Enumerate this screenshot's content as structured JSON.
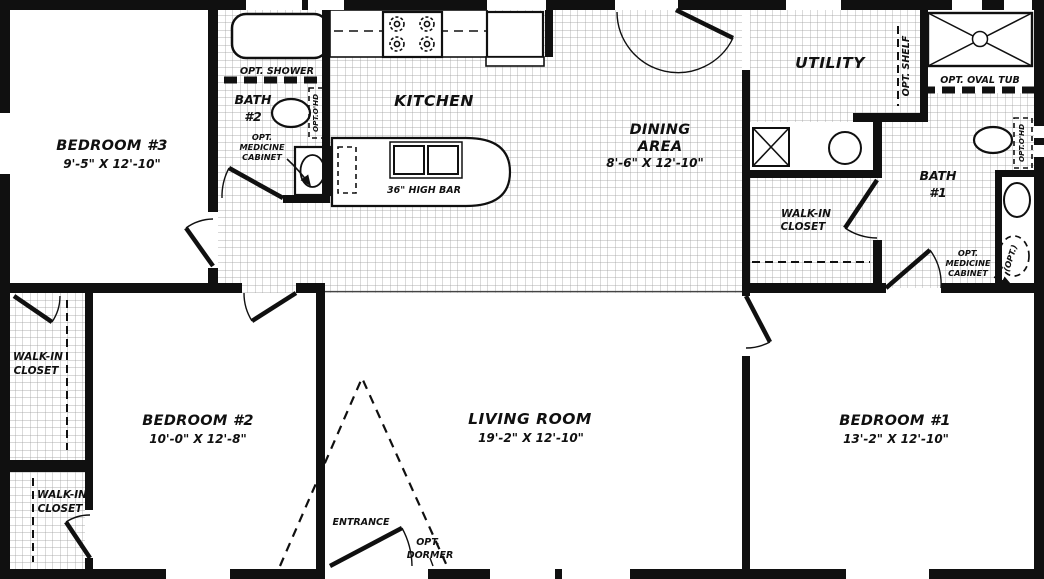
{
  "rooms": {
    "bedroom3": {
      "name": "BEDROOM #3",
      "dims": "9'-5\" X 12'-10\""
    },
    "bath2": {
      "line1": "BATH",
      "line2": "#2"
    },
    "kitchen": {
      "name": "KITCHEN"
    },
    "dining": {
      "line1": "DINING",
      "line2": "AREA",
      "dims": "8'-6\" X 12'-10\""
    },
    "utility": {
      "name": "UTILITY"
    },
    "bath1": {
      "line1": "BATH",
      "line2": "#1"
    },
    "bedroom2": {
      "name": "BEDROOM #2",
      "dims": "10'-0\" X 12'-8\""
    },
    "living": {
      "name": "LIVING ROOM",
      "dims": "19'-2\" X 12'-10\""
    },
    "bedroom1": {
      "name": "BEDROOM #1",
      "dims": "13'-2\" X 12'-10\""
    },
    "walkin": {
      "line1": "WALK-IN",
      "line2": "CLOSET"
    }
  },
  "labels": {
    "opt_shower": "OPT. SHOWER",
    "opt_oval_tub": "OPT. OVAL TUB",
    "opt_shelf": "OPT. SHELF",
    "opt_ohd": "OPT.O'HD",
    "opt_med1": "OPT.",
    "opt_med2": "MEDICINE",
    "opt_med3": "CABINET",
    "high_bar": "36\" HIGH BAR",
    "entrance": "ENTRANCE",
    "opt_dormer1": "OPT.",
    "opt_dormer2": "DORMER",
    "opt_toilet": "(OPT.)"
  },
  "colors": {
    "wall": "#101010",
    "tile_line": "#989898",
    "background": "#ffffff"
  }
}
